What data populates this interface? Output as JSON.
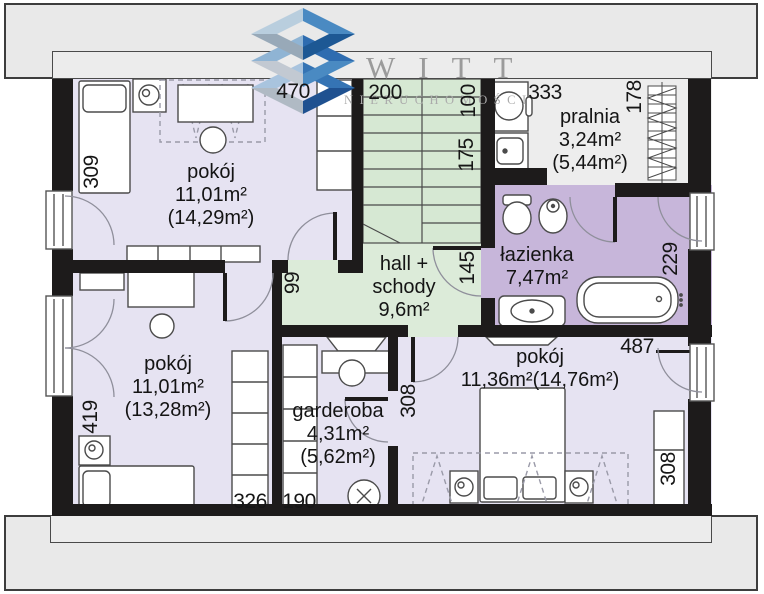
{
  "watermark": {
    "brand": "WITT",
    "subtitle": "NIERUCHOMOŚCI"
  },
  "rooms": [
    {
      "key": "pokoj-top-left",
      "lines": [
        "pokój",
        "11,01m²",
        "(14,29m²)"
      ]
    },
    {
      "key": "pralnia",
      "lines": [
        "pralnia",
        "3,24m²",
        "(5,44m²)"
      ]
    },
    {
      "key": "lazienka",
      "lines": [
        "łazienka",
        "7,47m²"
      ]
    },
    {
      "key": "hall-schody",
      "lines": [
        "hall +",
        "schody",
        "9,6m²"
      ]
    },
    {
      "key": "pokoj-bottom-left",
      "lines": [
        "pokój",
        "11,01m²",
        "(13,28m²)"
      ]
    },
    {
      "key": "garderoba",
      "lines": [
        "garderoba",
        "4,31m²",
        "(5,62m²)"
      ]
    },
    {
      "key": "pokoj-bottom-right",
      "lines": [
        "pokój",
        "11,36m²(14,76m²)"
      ]
    }
  ],
  "dims": [
    "470",
    "200",
    "100",
    "333",
    "178",
    "175",
    "309",
    "99",
    "145",
    "229",
    "419",
    "326",
    "190",
    "308",
    "487",
    "308"
  ],
  "colors": {
    "wall": "#1d1b1b",
    "room_lavender": "#e6e3f2",
    "room_green": "#dcebd9",
    "room_purple": "#c7b6da",
    "room_gray": "#ededed",
    "band_gray": "#e9e9e9",
    "logo_blue_dark": "#1d5894",
    "logo_blue": "#3574b4",
    "logo_blue_light": "#a9c4de",
    "logo_gray": "#b8c0ca"
  }
}
